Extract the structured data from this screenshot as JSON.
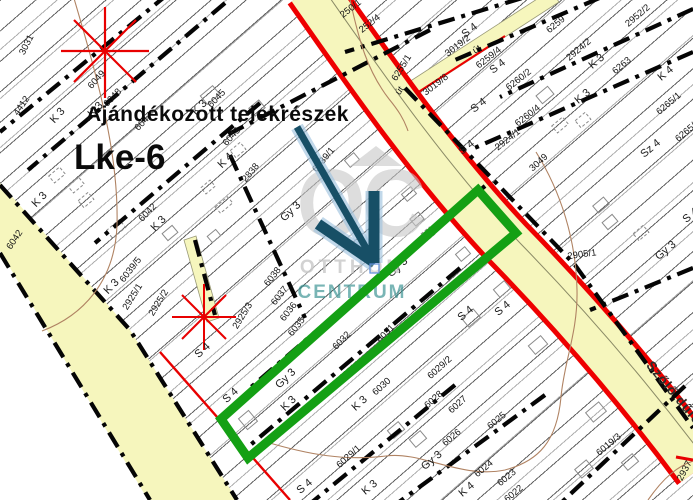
{
  "annotations": {
    "gift_title": "Ajándékozott telekrészek",
    "zone_code": "Lke-6"
  },
  "watermark": {
    "logo": "OC",
    "name_line1": "OTTHON",
    "name_line2": "CENTRUM"
  },
  "colors": {
    "road_fill": "#f6f6bd",
    "road_border_red": "#ee0000",
    "highlight_green": "#14a014",
    "arrow_blue": "#174f66",
    "arrow_halo": "#9fc3df",
    "survey_star_red": "#e80000",
    "contour_brown": "#b08363",
    "watermark_gray": "#c6c6c6",
    "watermark_teal": "#2d8c8c"
  },
  "map_labels": [
    {
      "t": "3031",
      "x": 27,
      "y": 45,
      "r": -63
    },
    {
      "t": "4412",
      "x": 22,
      "y": 106,
      "r": -56
    },
    {
      "t": "6049",
      "x": 97,
      "y": 80,
      "r": -48
    },
    {
      "t": "K 3",
      "x": 58,
      "y": 116,
      "r": -48,
      "k": "z"
    },
    {
      "t": "6048",
      "x": 113,
      "y": 98,
      "r": -46
    },
    {
      "t": "K 3",
      "x": 96,
      "y": 110,
      "r": -46,
      "k": "z"
    },
    {
      "t": "6047",
      "x": 144,
      "y": 122,
      "r": -46
    },
    {
      "t": "K 3",
      "x": 200,
      "y": 108,
      "r": -46,
      "k": "z"
    },
    {
      "t": "6045",
      "x": 217,
      "y": 99,
      "r": -46
    },
    {
      "t": "6043",
      "x": 232,
      "y": 137,
      "r": -48
    },
    {
      "t": "K 4",
      "x": 226,
      "y": 161,
      "r": -45,
      "k": "z"
    },
    {
      "t": "2838",
      "x": 251,
      "y": 173,
      "r": -50
    },
    {
      "t": "6042",
      "x": 148,
      "y": 213,
      "r": -46
    },
    {
      "t": "K 3",
      "x": 159,
      "y": 224,
      "r": -46,
      "k": "z"
    },
    {
      "t": "K 3",
      "x": 40,
      "y": 200,
      "r": -46,
      "k": "z"
    },
    {
      "t": "6042",
      "x": 15,
      "y": 240,
      "r": -56
    },
    {
      "t": "Gy 3",
      "x": 291,
      "y": 212,
      "r": -44,
      "k": "z"
    },
    {
      "t": "6039/1",
      "x": 324,
      "y": 160,
      "r": -50
    },
    {
      "t": "6039/5",
      "x": 131,
      "y": 270,
      "r": -52
    },
    {
      "t": "K 3",
      "x": 112,
      "y": 287,
      "r": -46,
      "k": "z"
    },
    {
      "t": "2925/1",
      "x": 133,
      "y": 297,
      "r": -58
    },
    {
      "t": "2925/2",
      "x": 159,
      "y": 303,
      "r": -58
    },
    {
      "t": "2925/3",
      "x": 243,
      "y": 316,
      "r": -58
    },
    {
      "t": "6038",
      "x": 273,
      "y": 277,
      "r": -52
    },
    {
      "t": "6037",
      "x": 280,
      "y": 296,
      "r": -52
    },
    {
      "t": "6036",
      "x": 289,
      "y": 312,
      "r": -52
    },
    {
      "t": "6035",
      "x": 297,
      "y": 327,
      "r": -52
    },
    {
      "t": "6032",
      "x": 342,
      "y": 341,
      "r": -46
    },
    {
      "t": "6031",
      "x": 386,
      "y": 334,
      "r": -46
    },
    {
      "t": "Gy 3",
      "x": 398,
      "y": 268,
      "r": -42,
      "k": "z"
    },
    {
      "t": "Gy 3",
      "x": 286,
      "y": 379,
      "r": -44,
      "k": "z"
    },
    {
      "t": "K 3",
      "x": 289,
      "y": 404,
      "r": -44,
      "k": "z"
    },
    {
      "t": "6030",
      "x": 382,
      "y": 387,
      "r": -42
    },
    {
      "t": "K 3",
      "x": 360,
      "y": 404,
      "r": -42,
      "k": "z"
    },
    {
      "t": "6029/2",
      "x": 440,
      "y": 368,
      "r": -42
    },
    {
      "t": "6028",
      "x": 434,
      "y": 400,
      "r": -42
    },
    {
      "t": "6027",
      "x": 458,
      "y": 405,
      "r": -42
    },
    {
      "t": "6029/1",
      "x": 349,
      "y": 457,
      "r": -42
    },
    {
      "t": "Gy 3",
      "x": 432,
      "y": 461,
      "r": -40,
      "k": "z"
    },
    {
      "t": "6026",
      "x": 452,
      "y": 438,
      "r": -40
    },
    {
      "t": "6025",
      "x": 497,
      "y": 421,
      "r": -40
    },
    {
      "t": "6024",
      "x": 484,
      "y": 469,
      "r": -40
    },
    {
      "t": "6023",
      "x": 507,
      "y": 478,
      "r": -40
    },
    {
      "t": "6022",
      "x": 514,
      "y": 494,
      "r": -40
    },
    {
      "t": "K 3",
      "x": 370,
      "y": 488,
      "r": -40,
      "k": "z"
    },
    {
      "t": "K 4",
      "x": 467,
      "y": 490,
      "r": -40,
      "k": "z"
    },
    {
      "t": "S 4",
      "x": 305,
      "y": 487,
      "r": -40,
      "k": "z"
    },
    {
      "t": "2905/1",
      "x": 582,
      "y": 255,
      "r": -8
    },
    {
      "t": "3049",
      "x": 539,
      "y": 163,
      "r": -42
    },
    {
      "t": "Gy 3",
      "x": 666,
      "y": 251,
      "r": -40,
      "k": "z"
    },
    {
      "t": "Sz 4",
      "x": 651,
      "y": 149,
      "r": -40,
      "k": "z"
    },
    {
      "t": "S 4",
      "x": 691,
      "y": 216,
      "r": -40,
      "k": "z"
    },
    {
      "t": "K 3",
      "x": 597,
      "y": 62,
      "r": -40,
      "k": "z"
    },
    {
      "t": "K 3",
      "x": 583,
      "y": 97,
      "r": -40,
      "k": "z"
    },
    {
      "t": "6263",
      "x": 622,
      "y": 66,
      "r": -40
    },
    {
      "t": "K 4",
      "x": 666,
      "y": 74,
      "r": -40,
      "k": "z"
    },
    {
      "t": "2952/2",
      "x": 638,
      "y": 16,
      "r": -40
    },
    {
      "t": "6259",
      "x": 556,
      "y": 25,
      "r": -40
    },
    {
      "t": "2924/2",
      "x": 579,
      "y": 50,
      "r": -40
    },
    {
      "t": "2924/1",
      "x": 508,
      "y": 140,
      "r": -38
    },
    {
      "t": "6260/2",
      "x": 519,
      "y": 80,
      "r": -38
    },
    {
      "t": "6260/4",
      "x": 528,
      "y": 116,
      "r": -38
    },
    {
      "t": "6265/1",
      "x": 669,
      "y": 104,
      "r": -40
    },
    {
      "t": "6265/2",
      "x": 688,
      "y": 131,
      "r": -40
    },
    {
      "t": "6259/4",
      "x": 489,
      "y": 58,
      "r": -38
    },
    {
      "t": "S 4",
      "x": 498,
      "y": 67,
      "r": -38,
      "k": "z"
    },
    {
      "t": "S 4",
      "x": 470,
      "y": 31,
      "r": -38,
      "k": "z"
    },
    {
      "t": "S 4",
      "x": 479,
      "y": 106,
      "r": -38,
      "k": "z"
    },
    {
      "t": "S 4",
      "x": 467,
      "y": 148,
      "r": -38,
      "k": "z"
    },
    {
      "t": "S 4",
      "x": 203,
      "y": 351,
      "r": -42,
      "k": "z"
    },
    {
      "t": "S 4",
      "x": 231,
      "y": 396,
      "r": -42,
      "k": "z"
    },
    {
      "t": "S 4",
      "x": 466,
      "y": 314,
      "r": -40,
      "k": "z"
    },
    {
      "t": "S 4",
      "x": 503,
      "y": 309,
      "r": -40,
      "k": "z"
    },
    {
      "t": "3019/2",
      "x": 458,
      "y": 46,
      "r": -38
    },
    {
      "t": "3019/8",
      "x": 436,
      "y": 85,
      "r": -38
    },
    {
      "t": "6255/1",
      "x": 402,
      "y": 68,
      "r": -58
    },
    {
      "t": "252/4",
      "x": 370,
      "y": 24,
      "r": -38
    },
    {
      "t": "250/1",
      "x": 351,
      "y": 9,
      "r": -38
    },
    {
      "t": "út",
      "x": 400,
      "y": 91,
      "r": -55,
      "k": "u"
    },
    {
      "t": "út",
      "x": 477,
      "y": 50,
      "r": -30,
      "k": "u"
    },
    {
      "t": "Szőlő dűlő",
      "x": 674,
      "y": 393,
      "r": 50,
      "k": "s"
    },
    {
      "t": "6019/3",
      "x": 609,
      "y": 445,
      "r": -40
    },
    {
      "t": "2937",
      "x": 685,
      "y": 471,
      "r": -62
    }
  ]
}
